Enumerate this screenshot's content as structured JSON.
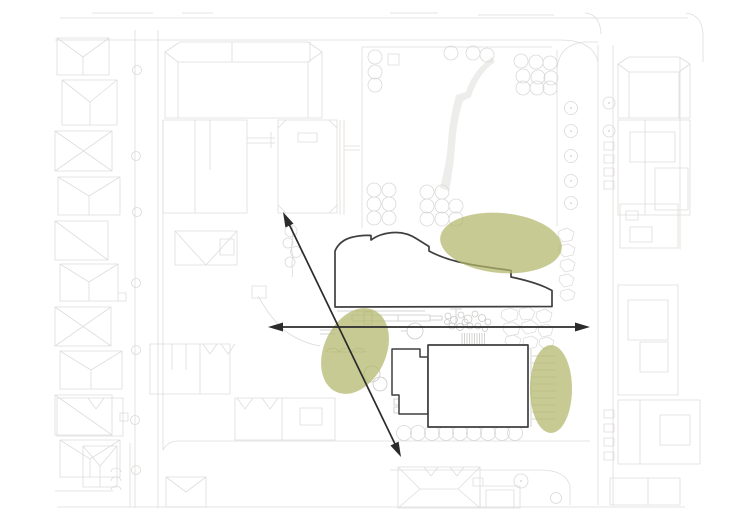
{
  "diagram": {
    "kind": "architectural-site-plan-concept-diagram",
    "base": "faint gray site plan with streets, house footprints, trees and paths",
    "proposal": {
      "north_building": "organic curved-roof footprint outlined in black",
      "south_building": "rectangular footprint with stepped annex outlined in black"
    },
    "highlights": [
      {
        "name": "vegetation-zone-north"
      },
      {
        "name": "vegetation-zone-southwest"
      },
      {
        "name": "vegetation-zone-east"
      }
    ],
    "axes": [
      {
        "name": "axis-arrow-horizontal",
        "direction": "east-west",
        "heads": 2
      },
      {
        "name": "axis-arrow-diagonal",
        "direction": "northeast-southwest",
        "heads": 2
      }
    ]
  },
  "colors": {
    "background": "#ffffff",
    "plan_line": "#dedddb",
    "plan_strong": "#d2d2d0",
    "plan_detail": "#c9c9c7",
    "park_path": "#ededeb",
    "tree_line": "#d9d9d7",
    "outline": "#3f3f3f",
    "building_fill": "#ffffff",
    "green": "#b1b76a",
    "arrow": "#2b2b2b"
  }
}
